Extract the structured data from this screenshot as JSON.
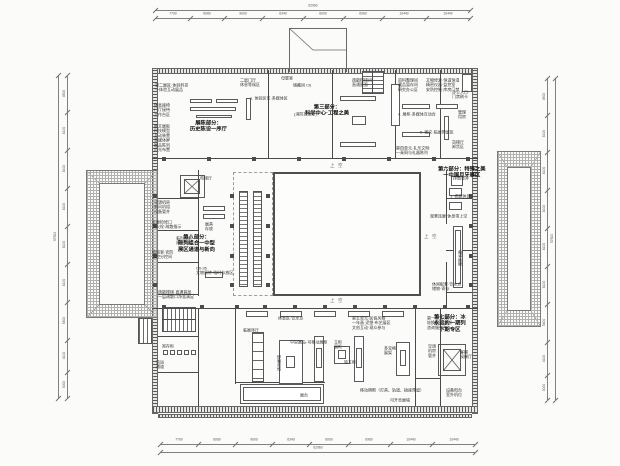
{
  "colors": {
    "paper": "#fbfbf9",
    "line": "#4a4a4a",
    "hatch": "#b0b0ae",
    "dim": "#707070"
  },
  "dimensions": {
    "top": {
      "values": [
        "7700",
        "6080",
        "9000",
        "6340",
        "6000",
        "6960",
        "10440",
        "10440"
      ],
      "total": "62960"
    },
    "bottom": {
      "values": [
        "7700",
        "6080",
        "9000",
        "6340",
        "6000",
        "6960",
        "10440",
        "10440"
      ],
      "total": "62960"
    },
    "left": {
      "values": [
        "4500",
        "8100",
        "8100",
        "8100",
        "8100",
        "8100",
        "5400",
        "4100",
        "3000"
      ],
      "total": "57500"
    },
    "right": {
      "values": [
        "4500",
        "8100",
        "8100",
        "8100",
        "8100",
        "8100",
        "5400",
        "4100",
        "3000"
      ],
      "total": "57500"
    }
  },
  "zone_labels": [
    {
      "x": 190,
      "y": 120,
      "t": "展陈部分：\n历史陈设一序厅"
    },
    {
      "x": 305,
      "y": 104,
      "t": "第三部分：\n科学中心·工程之美"
    },
    {
      "x": 438,
      "y": 166,
      "t": "第六部分：特殊之美\n一中国月牙展区"
    },
    {
      "x": 434,
      "y": 314,
      "t": "第七部分：冰\n永远的一期列\n下期专区"
    },
    {
      "x": 178,
      "y": 234,
      "t": "第八部分：\n陈列组合一中型\n展区通道与新向"
    }
  ],
  "void_labels": [
    {
      "x": 330,
      "y": 163,
      "t": "上 空"
    },
    {
      "x": 330,
      "y": 298,
      "t": "上 空"
    },
    {
      "x": 424,
      "y": 234,
      "t": "上 空"
    }
  ],
  "vertical_labels": [
    {
      "x": 458,
      "y": 266,
      "t": "观景长廊"
    },
    {
      "x": 277,
      "y": 371,
      "t": "活动展墙"
    }
  ],
  "annotations": [
    {
      "x": 155,
      "y": 83,
      "t": "第二展区·体验科技\n一体验互动展品"
    },
    {
      "x": 154,
      "y": 103,
      "t": "休息座椅\n门厅接待\n工作台区"
    },
    {
      "x": 154,
      "y": 124,
      "t": "图文展板\n科技模型\n互动装置\n多媒体屏\n展品陈列\n灯光布置"
    },
    {
      "x": 240,
      "y": 78,
      "t": "二层门厅\n休息等候区"
    },
    {
      "x": 281,
      "y": 76,
      "t": "母婴室"
    },
    {
      "x": 293,
      "y": 83,
      "t": "储藏间 C6"
    },
    {
      "x": 250,
      "y": 96,
      "t": "1. 体验区位·多媒体区"
    },
    {
      "x": 294,
      "y": 112,
      "t": "(消防控制室)"
    },
    {
      "x": 352,
      "y": 78,
      "t": "疏散楼梯间\n直通屋面"
    },
    {
      "x": 398,
      "y": 78,
      "t": "资料整理间\n藏品暂存间\n研究办公区"
    },
    {
      "x": 426,
      "y": 78,
      "t": "文物修复·恒温恒湿\n精密仪器·监控室\n安防控制·库房门禁"
    },
    {
      "x": 398,
      "y": 112,
      "t": "4. 展柜·多媒体互动台"
    },
    {
      "x": 452,
      "y": 90,
      "t": "办公入口\n门禁刷卡"
    },
    {
      "x": 458,
      "y": 110,
      "t": "管理\n用房"
    },
    {
      "x": 420,
      "y": 130,
      "t": "5. 图文·临展预留区"
    },
    {
      "x": 396,
      "y": 146,
      "t": "第四单元·礼乐文明\n一青铜与礼器陈列"
    },
    {
      "x": 452,
      "y": 140,
      "t": "货梯厅\n卸货区"
    },
    {
      "x": 453,
      "y": 176,
      "t": "排烟竖井"
    },
    {
      "x": 450,
      "y": 194,
      "t": "1. 檐廊休息"
    },
    {
      "x": 430,
      "y": 214,
      "t": "观景连廊·休息带上空"
    },
    {
      "x": 432,
      "y": 282,
      "t": "休闲配套·饮水点\n储物·寄存"
    },
    {
      "x": 154,
      "y": 200,
      "t": "空调机房\n新风机组\n设备管井"
    },
    {
      "x": 152,
      "y": 220,
      "t": "走廊检修口\n消火栓·疏散指示"
    },
    {
      "x": 176,
      "y": 236,
      "t": "临时库房\n周转存放"
    },
    {
      "x": 152,
      "y": 250,
      "t": "值班室·安防\n监控分控间"
    },
    {
      "x": 196,
      "y": 266,
      "t": "C0-26\n文物周转·临时存放区"
    },
    {
      "x": 158,
      "y": 290,
      "t": "疏散楼梯·直通首层\n一层疏散口净宽满足"
    },
    {
      "x": 278,
      "y": 316,
      "t": "休息区·饮水点"
    },
    {
      "x": 243,
      "y": 328,
      "t": "临展序厅"
    },
    {
      "x": 352,
      "y": 316,
      "t": "第五单元·民俗风物\n一年画·泥塑·布艺展区\n文创互动·观众参与"
    },
    {
      "x": 427,
      "y": 316,
      "t": "第一单元·序厅\n轮换展项·导引\n咨询服务台"
    },
    {
      "x": 290,
      "y": 340,
      "t": "中央展岛·可移动展柜"
    },
    {
      "x": 334,
      "y": 340,
      "t": "立柜\n展柜"
    },
    {
      "x": 384,
      "y": 346,
      "t": "多宝格\n展架"
    },
    {
      "x": 344,
      "y": 360,
      "t": "独立柜"
    },
    {
      "x": 428,
      "y": 344,
      "t": "空调\n机房\n管井"
    },
    {
      "x": 460,
      "y": 350,
      "t": "客梯\n候梯厅"
    },
    {
      "x": 360,
      "y": 388,
      "t": "移动隔断（灯具、轨道、插座预留）"
    },
    {
      "x": 300,
      "y": 393,
      "t": "展台"
    },
    {
      "x": 390,
      "y": 398,
      "t": "可开合展墙"
    },
    {
      "x": 446,
      "y": 388,
      "t": "设备阳台\n室外机位"
    },
    {
      "x": 162,
      "y": 344,
      "t": "寄存柜"
    },
    {
      "x": 156,
      "y": 360,
      "t": "货运\n通道"
    },
    {
      "x": 200,
      "y": 176,
      "t": "电梯厅"
    },
    {
      "x": 205,
      "y": 222,
      "t": "展具\n存放"
    }
  ]
}
